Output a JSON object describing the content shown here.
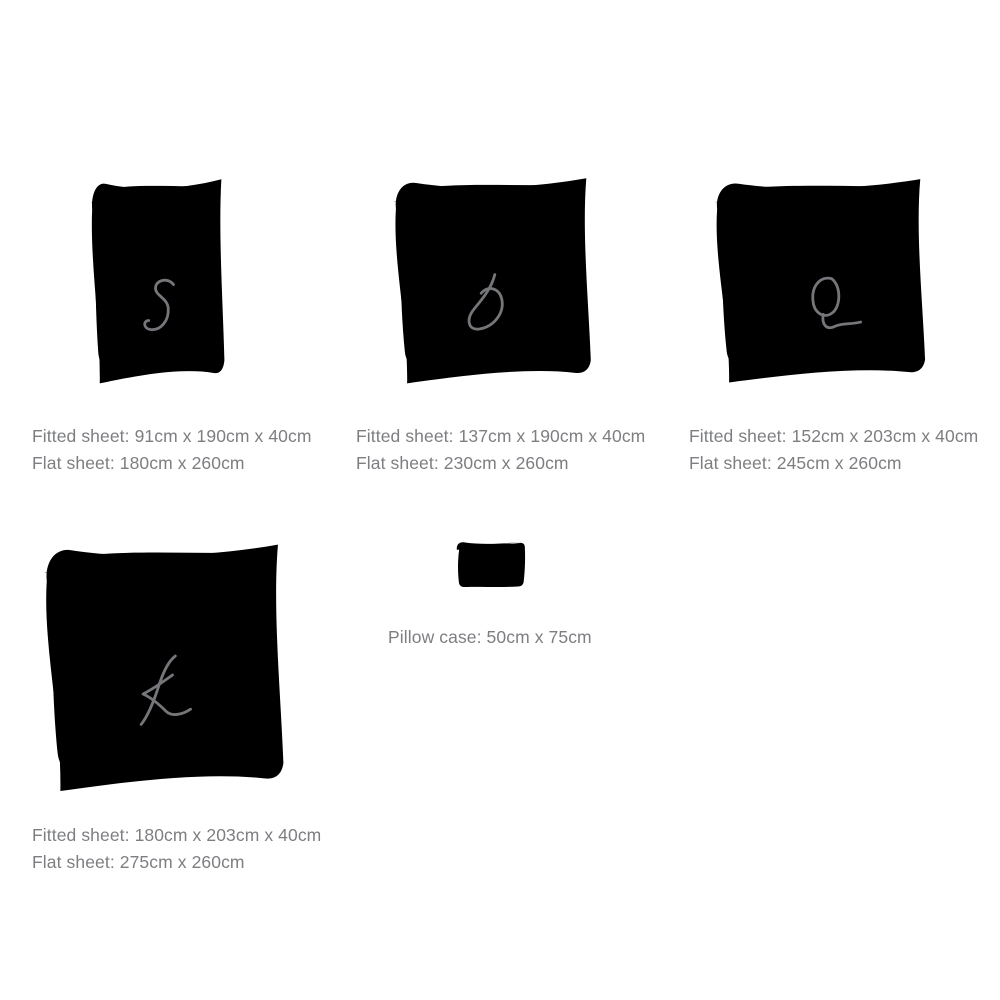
{
  "colors": {
    "background": "#ffffff",
    "sketch": "#75767a",
    "text": "#7d7e81"
  },
  "sizes": [
    {
      "letter": "S",
      "fitted": "Fitted sheet: 91cm x 190cm x 40cm",
      "flat": "Flat sheet: 180cm x 260cm"
    },
    {
      "letter": "D",
      "fitted": "Fitted sheet: 137cm x 190cm x 40cm",
      "flat": "Flat sheet: 230cm x 260cm"
    },
    {
      "letter": "Q",
      "fitted": "Fitted sheet: 152cm x 203cm x 40cm",
      "flat": "Flat sheet: 245cm x 260cm"
    },
    {
      "letter": "K",
      "fitted": "Fitted sheet: 180cm x 203cm x 40cm",
      "flat": "Flat sheet: 275cm x 260cm"
    }
  ],
  "pillow": {
    "label": "Pillow case: 50cm x 75cm"
  }
}
